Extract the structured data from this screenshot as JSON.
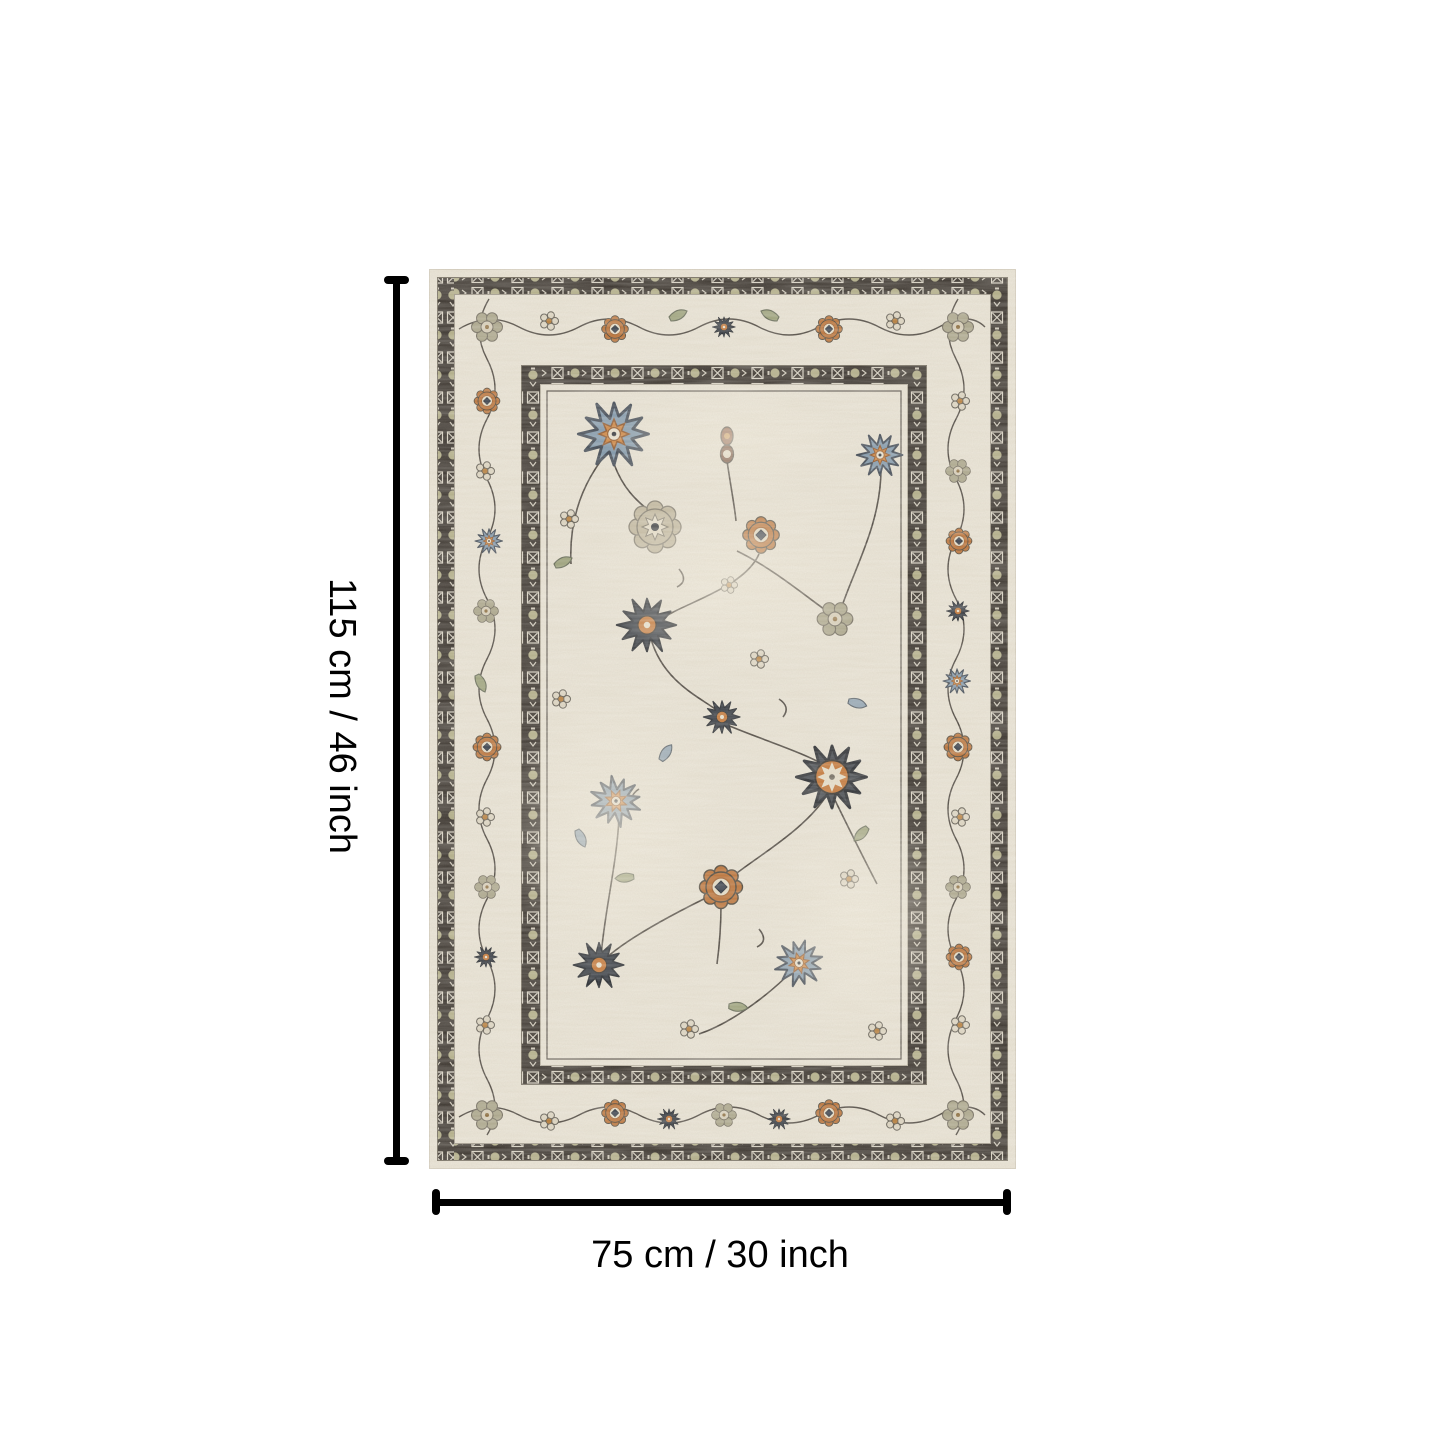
{
  "image_type": "product dimension diagram",
  "dimensions": {
    "height_label": "115 cm / 46 inch",
    "width_label": "75 cm / 30 inch"
  },
  "product": {
    "name": "vintage oriental style area rug",
    "shape": "rectangle",
    "palette": {
      "field_ivory": "#e8e2d3",
      "border_charcoal": "#332d27",
      "accent_rust": "#b96d30",
      "accent_slate_blue": "#7e96aa",
      "accent_navy": "#2d333c",
      "accent_sage": "#a8a387",
      "accent_tan": "#beb49a"
    }
  },
  "annotation": {
    "line_color": "#000000",
    "background": "#ffffff"
  }
}
